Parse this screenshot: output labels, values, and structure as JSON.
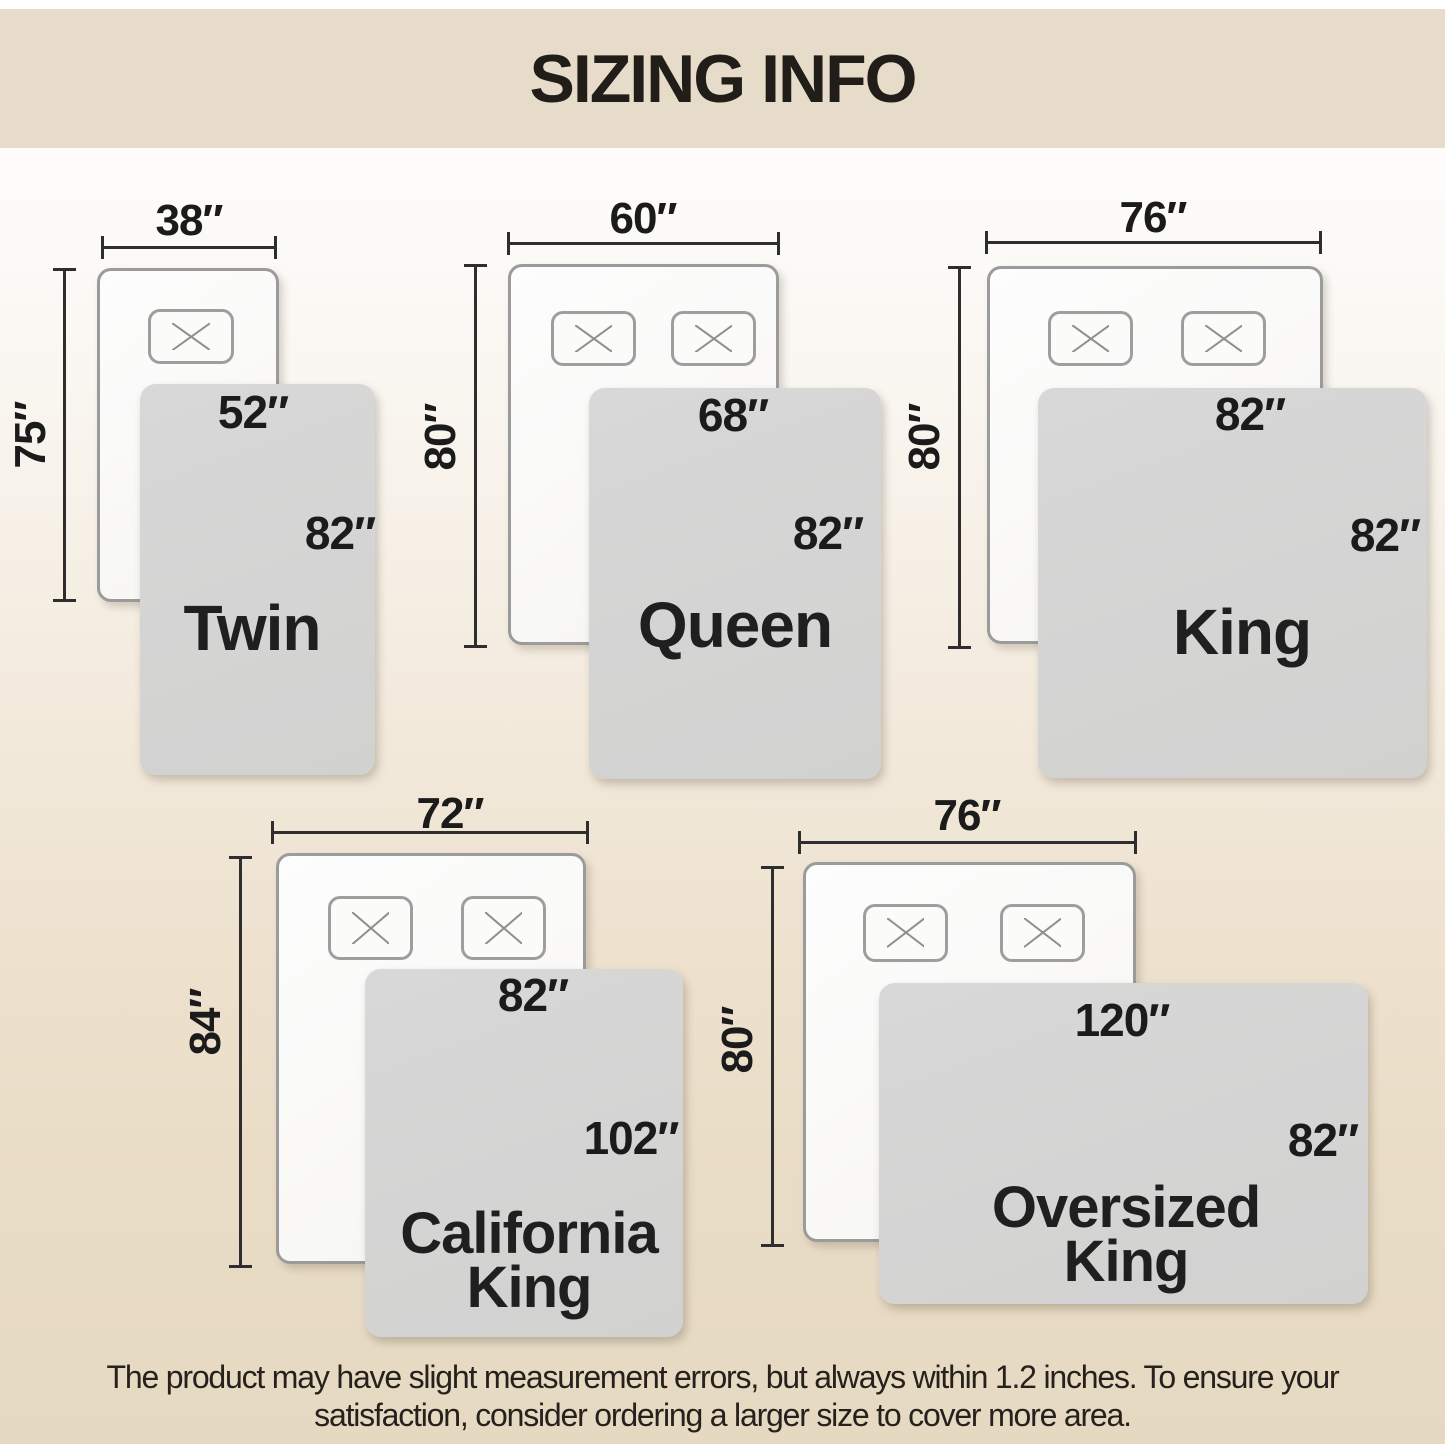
{
  "header": {
    "title": "SIZING INFO"
  },
  "sizes": [
    {
      "name": "Twin",
      "bed_width": "38″",
      "bed_length": "75″",
      "blanket_width": "52″",
      "blanket_length": "82″"
    },
    {
      "name": "Queen",
      "bed_width": "60″",
      "bed_length": "80″",
      "blanket_width": "68″",
      "blanket_length": "82″"
    },
    {
      "name": "King",
      "bed_width": "76″",
      "bed_length": "80″",
      "blanket_width": "82″",
      "blanket_length": "82″"
    },
    {
      "name_line1": "California",
      "name_line2": "King",
      "bed_width": "72″",
      "bed_length": "84″",
      "blanket_width": "82″",
      "blanket_length": "102″"
    },
    {
      "name_line1": "Oversized",
      "name_line2": "King",
      "bed_width": "76″",
      "bed_length": "80″",
      "blanket_width": "120″",
      "blanket_length": "82″"
    }
  ],
  "footer": {
    "line1": "The product may have slight measurement errors, but always within 1.2 inches. To ensure your",
    "line2": "satisfaction, consider ordering a larger size to cover more area."
  },
  "colors": {
    "band": "#e6dcc9",
    "blanket": "#d3d3d3",
    "bed_border": "#9b9b9b",
    "dimension_line": "#2e2e2e",
    "text": "#1b1b1b"
  }
}
